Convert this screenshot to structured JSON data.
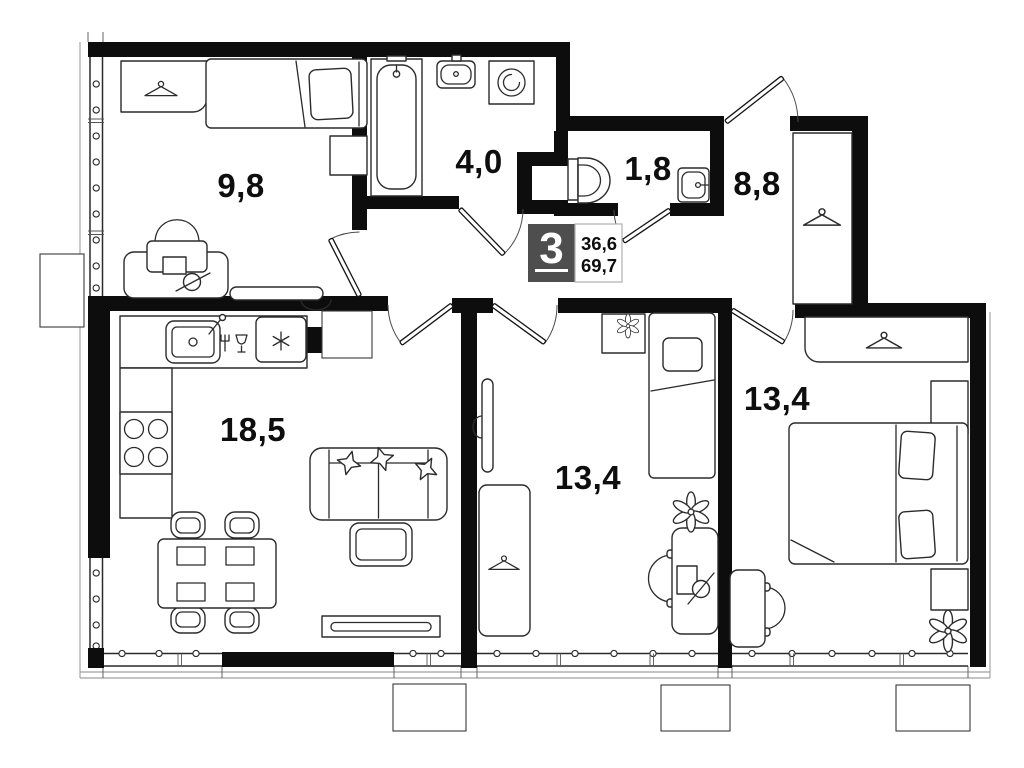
{
  "title": "3-room apartment floor plan",
  "badge": {
    "rooms": "3",
    "living_area": "36,6",
    "total_area": "69,7"
  },
  "rooms": [
    {
      "name": "bedroom-top-left",
      "area_label": "9,8",
      "furniture": [
        "wardrobe-hanger",
        "single-bed",
        "nightstand",
        "desk",
        "bag",
        "desk-lamp",
        "bench"
      ]
    },
    {
      "name": "bathroom",
      "area_label": "4,0",
      "furniture": [
        "bathtub",
        "washbasin",
        "washing-machine"
      ]
    },
    {
      "name": "wc",
      "area_label": "1,8",
      "furniture": [
        "toilet",
        "washbasin"
      ]
    },
    {
      "name": "hallway",
      "area_label": "8,8",
      "furniture": [
        "wardrobe-hanger"
      ]
    },
    {
      "name": "kitchen-living-room",
      "area_label": "18,5",
      "furniture": [
        "kitchen-sink",
        "dishwasher",
        "refrigerator",
        "stove-4-burners",
        "dining-table",
        "4-chairs",
        "sofa",
        "pillows",
        "coffee-table",
        "tv-stand"
      ]
    },
    {
      "name": "room-middle",
      "area_label": "13,4",
      "furniture": [
        "single-bed",
        "nightstand-with-plant",
        "mirror",
        "wardrobe-hanger",
        "desk",
        "desk-chair",
        "desk-lamp",
        "plant"
      ]
    },
    {
      "name": "bedroom-right",
      "area_label": "13,4",
      "furniture": [
        "wardrobe-hanger",
        "double-bed",
        "nightstand",
        "nightstand",
        "desk",
        "desk-chair",
        "plant"
      ]
    }
  ],
  "colors": {
    "wall": "#0d0d0d",
    "line": "#2b2b2b",
    "badge_bg": "#4e4e4e",
    "badge_border": "#b0b0b0",
    "bg": "#ffffff"
  }
}
